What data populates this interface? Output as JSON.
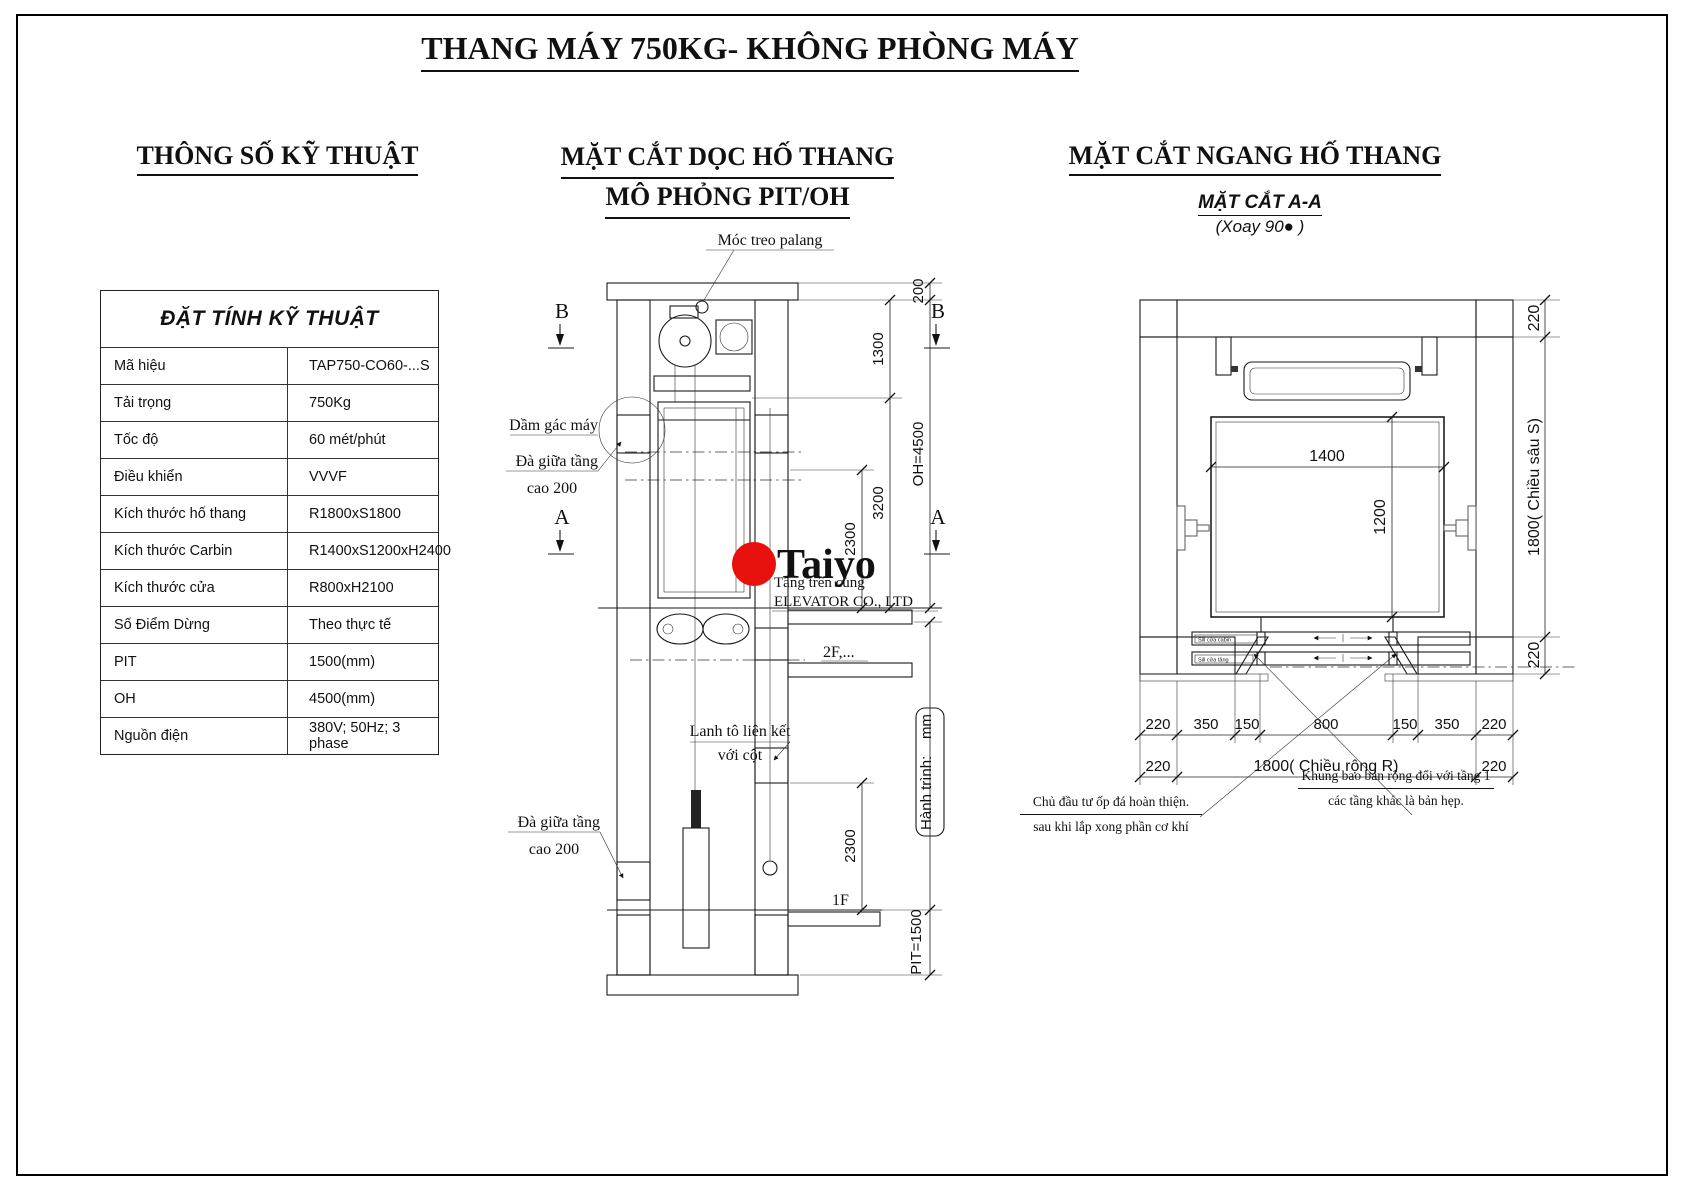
{
  "title": "THANG MÁY 750KG- KHÔNG PHÒNG MÁY",
  "specs": {
    "heading": "THÔNG SỐ KỸ THUẬT",
    "table_title": "ĐẶT TÍNH KỸ THUẬT",
    "rows": [
      {
        "label": "Mã hiệu",
        "value": "TAP750-CO60-...S"
      },
      {
        "label": "Tải trọng",
        "value": "750Kg"
      },
      {
        "label": "Tốc độ",
        "value": "60 mét/phút"
      },
      {
        "label": "Điều khiển",
        "value": "VVVF"
      },
      {
        "label": "Kích thước hố thang",
        "value": "R1800xS1800"
      },
      {
        "label": "Kích thước Carbin",
        "value": "R1400xS1200xH2400"
      },
      {
        "label": "Kích thước cửa",
        "value": "R800xH2100"
      },
      {
        "label": "Số Điểm Dừng",
        "value": "Theo thực tế"
      },
      {
        "label": "PIT",
        "value": "1500(mm)"
      },
      {
        "label": "OH",
        "value": "4500(mm)"
      },
      {
        "label": "Nguồn điện",
        "value": "380V; 50Hz; 3 phase"
      }
    ]
  },
  "section": {
    "heading1": "MẶT CẮT DỌC HỐ THANG",
    "heading2": "MÔ PHỎNG PIT/OH",
    "labels": {
      "hook": "Móc treo palang",
      "machine_beam": "Dầm gác máy",
      "mid_beam_line1": "Đà giữa tầng",
      "mid_beam_line2": "cao 200",
      "lintel_line1": "Lanh tô liên kết",
      "lintel_line2": "với cột",
      "floor_top": "Tầng trên cùng",
      "floor_2": "2F,...",
      "floor_1": "1F",
      "marker_b": "B",
      "marker_a": "A"
    },
    "dims": {
      "slab": "200",
      "machine": "1300",
      "upper": "3200",
      "door_top": "2300",
      "oh": "OH=4500",
      "travel": "Hành trình:    mm",
      "door_low": "2300",
      "pit": "PIT=1500"
    },
    "logo": {
      "name": "Taiyo",
      "company": "ELEVATOR CO., LTD",
      "accent_red": "#e8100c"
    }
  },
  "plan": {
    "heading": "MẶT CẮT NGANG HỐ THANG",
    "subtitle": "MẶT CẮT A-A",
    "subtitle_note": "(Xoay 90● )",
    "dims": {
      "cabin_w": "1400",
      "cabin_d": "1200",
      "wall_top": "220",
      "depth": "1800( Chiều sâu S)",
      "wall_bottom": "220",
      "b1": "220",
      "b2": "350",
      "b3": "150",
      "b4": "800",
      "b5": "150",
      "b6": "350",
      "b7": "220",
      "b8": "220",
      "width_total": "1800( Chiều rộng R)",
      "b9": "220"
    },
    "labels": {
      "sill_cabin": "Sill cửa cabin",
      "sill_landing": "Sill cửa tầng"
    },
    "notes": {
      "left1": "Chủ đầu tư ốp đá hoàn thiện.",
      "left2": "sau khi lắp xong phần cơ khí",
      "right1": "Khung bao bản rộng đổi với tầng 1",
      "right2": "các tầng khác là bản hẹp."
    }
  }
}
